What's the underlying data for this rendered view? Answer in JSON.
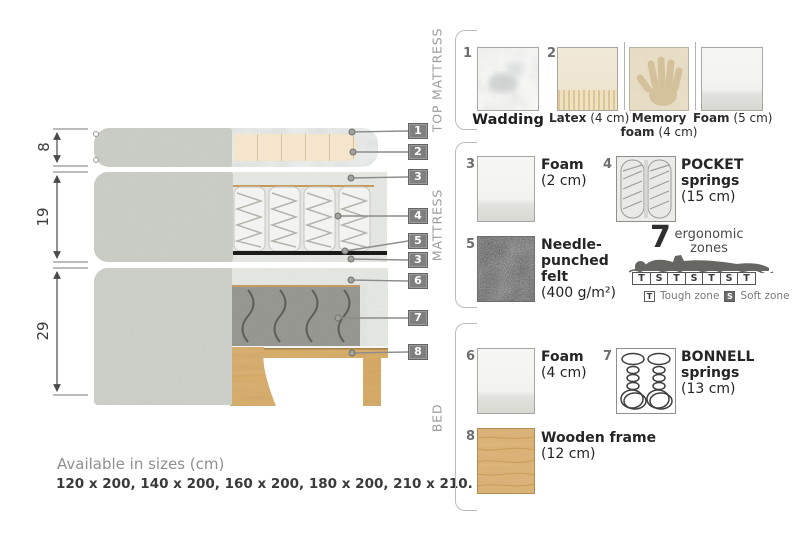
{
  "diagram": {
    "callouts": [
      "1",
      "2",
      "3",
      "4",
      "5",
      "3",
      "6",
      "7",
      "8"
    ],
    "dims": [
      "8",
      "19",
      "29"
    ],
    "available_title": "Available in sizes (cm)",
    "available_sizes": "120 x 200, 140 x 200, 160 x 200, 180 x 200, 210 x 210."
  },
  "sections": {
    "top_mattress": {
      "label": "TOP MATTRESS",
      "items": {
        "wadding": {
          "num": "1",
          "name": "Wadding"
        },
        "latex": {
          "num": "2",
          "name": "Latex",
          "size": "(4 cm)"
        },
        "memory_foam": {
          "name": "Memory foam",
          "size": "(4 cm)"
        },
        "foam": {
          "name": "Foam",
          "size": "(5 cm)"
        }
      }
    },
    "mattress": {
      "label": "MATTRESS",
      "items": {
        "foam": {
          "num": "3",
          "name": "Foam",
          "size": "(2 cm)"
        },
        "pocket_springs": {
          "num": "4",
          "name": "POCKET springs",
          "size": "(15 cm)"
        },
        "felt": {
          "num": "5",
          "name": "Needle-punched felt",
          "size": "(400 g/m²)"
        }
      }
    },
    "bed": {
      "label": "BED",
      "items": {
        "foam": {
          "num": "6",
          "name": "Foam",
          "size": "(4 cm)"
        },
        "bonnell_springs": {
          "num": "7",
          "name": "BONNELL springs",
          "size": "(13 cm)"
        },
        "wooden_frame": {
          "num": "8",
          "name": "Wooden frame",
          "size": "(12 cm)"
        }
      }
    }
  },
  "ergonomic": {
    "number": "7",
    "caption_line1": "ergonomic",
    "caption_line2": "zones",
    "zones": [
      "T",
      "S",
      "T",
      "S",
      "T",
      "S",
      "T"
    ],
    "tough_key": "T",
    "tough_label": "Tough zone",
    "soft_key": "S",
    "soft_label": "Soft zone"
  },
  "colors": {
    "fabric": "#cdcfc9",
    "foamspeck": "#e9ebe6",
    "latex": "#f4e5cc",
    "wood": "#d9ab62",
    "bonnell": "#95958f",
    "springdark": "#5e5e5a",
    "badge": "#7f7f7f",
    "tanline": "#c79a5d",
    "feltdark": "#4f4f4f"
  }
}
